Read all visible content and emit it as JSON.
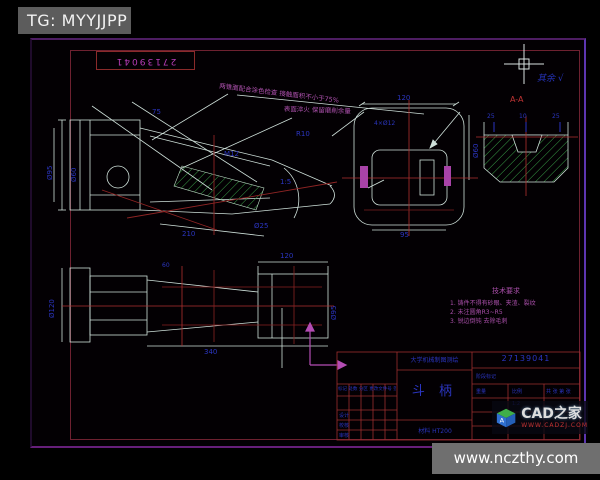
{
  "page": {
    "tg_label": "TG: MYYJJPP",
    "site_bar": "www.nczthy.com"
  },
  "brand": {
    "name": "CAD之家",
    "url": "WWW.CADZJ.COM",
    "logo": "cube-logo"
  },
  "frame": {
    "corner_no": "27139041",
    "finish_label": "其余",
    "finish_mark": "√"
  },
  "annotations": {
    "leader_note_1": "两锥面配合涂色检查 接触面积不小于75%",
    "leader_note_2": "表面淬火 保留磨削余量",
    "section_label": "A-A"
  },
  "notes": {
    "title": "技术要求",
    "items": [
      "1. 铸件不得有砂眼、夹渣、裂纹",
      "2. 未注圆角R3~R5",
      "3. 锐边倒钝 去除毛刺"
    ]
  },
  "dims": {
    "main": [
      "Ø95",
      "Ø60",
      "M12",
      "1:5",
      "R10",
      "Ø25",
      "210",
      "75"
    ],
    "front": [
      "120",
      "4×Ø12",
      "Ø60",
      "95"
    ],
    "section": [
      "25",
      "10",
      "25"
    ],
    "bottom": [
      "Ø120",
      "120",
      "340",
      "Ø95",
      "60"
    ]
  },
  "titleblock": {
    "school": "大学机械制图测绘",
    "drawing_no": "27139041",
    "part_name": "斗 柄",
    "material": "材料 HT200",
    "rev_header_line": "标记 处数 分区 更改文件号 签名 年月日",
    "roles": [
      "设计",
      "校核",
      "审核"
    ],
    "stage_label": "阶段标记",
    "weight_label": "重量",
    "scale_label": "比例",
    "scale_value": "1:2",
    "sheets": "共 张 第 张"
  },
  "colors": {
    "frame_magenta": "#661f7a",
    "inner_frame_red": "#6e2130",
    "line_white": "#cfe0da",
    "hatch_green": "#3aa348",
    "dim_blue": "#2b35c0",
    "centerline_red": "#b03030",
    "annotation_magenta": "#b052b0"
  }
}
